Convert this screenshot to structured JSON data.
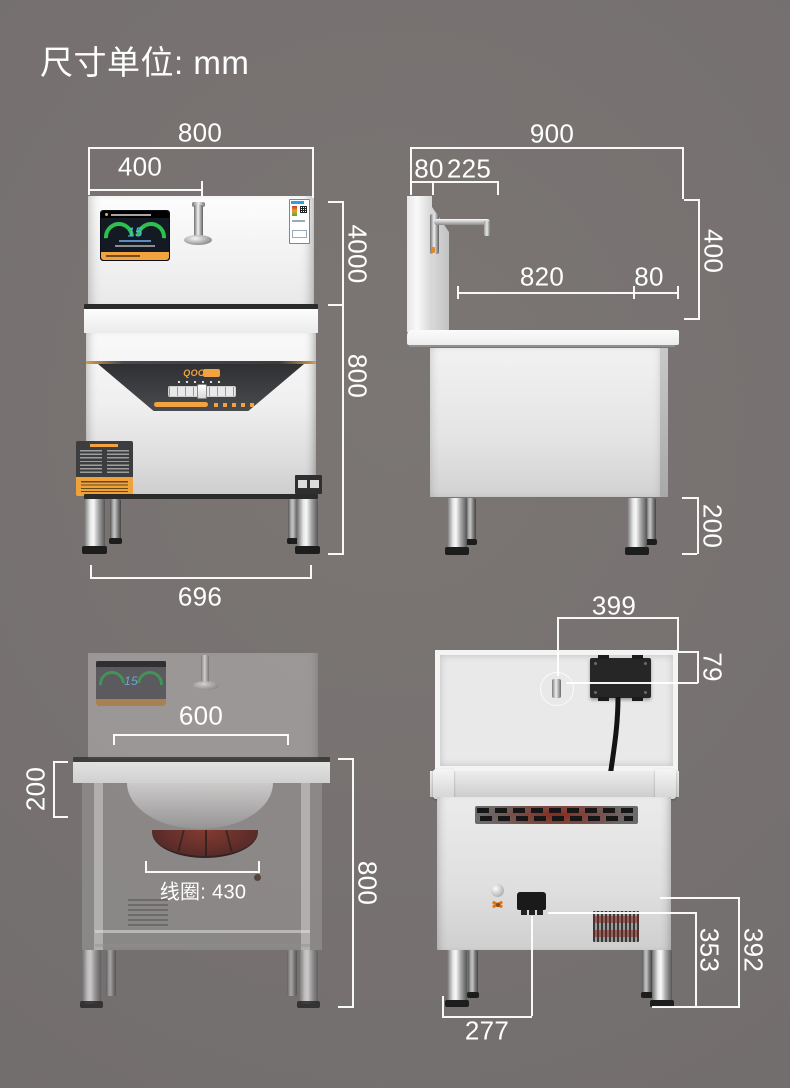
{
  "title": "尺寸单位: mm",
  "colors": {
    "background": "#757070",
    "dimension_lines": "#ffffff",
    "accent_orange": "#f2a340",
    "coil_red": "#7e2318",
    "screen_blue": "#57b7ff",
    "energy_label_blue": "#2e9fd8"
  },
  "icons": {
    "hazard": "hazard-warning-icon",
    "qr": "qr-code-icon",
    "faucet": "faucet-icon"
  },
  "views": {
    "front": {
      "name": "front view",
      "brand": "QOC",
      "screen_value": "15",
      "dim_width_top": "800",
      "dim_width_display": "400",
      "dim_height_upper": "4000",
      "dim_height_lower": "800",
      "dim_leg_span": "696"
    },
    "side": {
      "name": "side view",
      "dim_depth_top": "900",
      "dim_back_thickness": "80",
      "dim_faucet_offset": "225",
      "dim_backsplash_height": "400",
      "dim_counter_depth": "820",
      "dim_rear_overhang": "80",
      "dim_leg_height": "200"
    },
    "ghost": {
      "name": "front cutaway view",
      "dim_opening_width": "600",
      "dim_counter_height": "200",
      "coil_label": "线圈: 430",
      "dim_body_height": "800"
    },
    "back": {
      "name": "back view",
      "dim_box_offset": "399",
      "dim_box_height": "79",
      "dim_vent_height": "353",
      "dim_drain_height": "392",
      "dim_drain_offset": "277"
    }
  }
}
